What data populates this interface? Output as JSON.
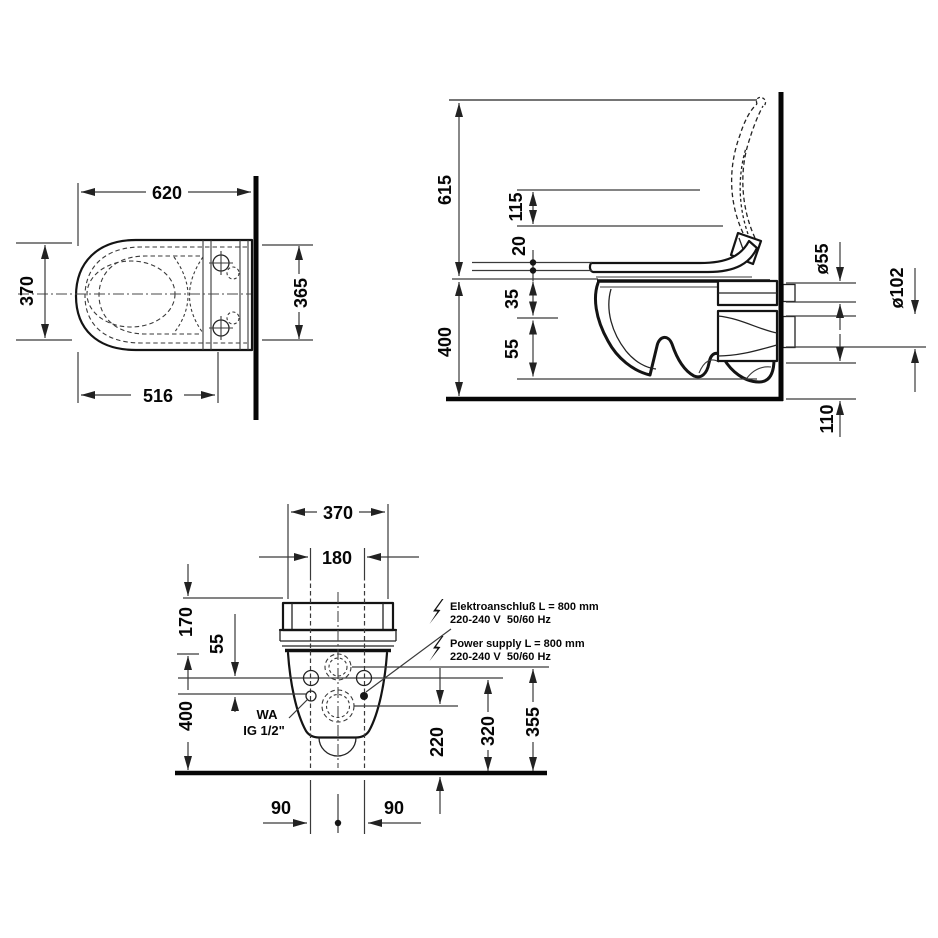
{
  "colors": {
    "ink": "#141414",
    "dim_line": "#3a3a3a",
    "background": "#ffffff"
  },
  "plan_view": {
    "dim_width_overall": "620",
    "dim_depth": "370",
    "dim_depth_at_wall": "365",
    "dim_width_bowl": "516"
  },
  "side_view": {
    "dim_height_lid_open": "615",
    "dim_lid_back": "115",
    "dim_seat_thickness": "20",
    "dim_rim_height": "400",
    "dim_rim_to_supply": "35",
    "dim_supply_to_bowl": "55",
    "dim_supply_pipe": "ø55",
    "dim_drain_pipe": "ø102",
    "dim_outlet_bottom": "110"
  },
  "rear_view": {
    "dim_width": "370",
    "dim_bolt_spacing": "180",
    "dim_top_to_holes": "170",
    "dim_holes_to_wa": "55",
    "dim_height": "400",
    "dim_drain_center_height": "220",
    "dim_bolt_height": "320",
    "dim_supply_height": "355",
    "dim_bolt_left": "90",
    "dim_bolt_right": "90",
    "water_label_line1": "WA",
    "water_label_line2": "IG 1/2\"",
    "electrical_de_line1": "Elektroanschluß L = 800 mm",
    "electrical_de_line2": "220-240 V  50/60 Hz",
    "electrical_en_line1": "Power supply L = 800 mm",
    "electrical_en_line2": "220-240 V  50/60 Hz"
  }
}
